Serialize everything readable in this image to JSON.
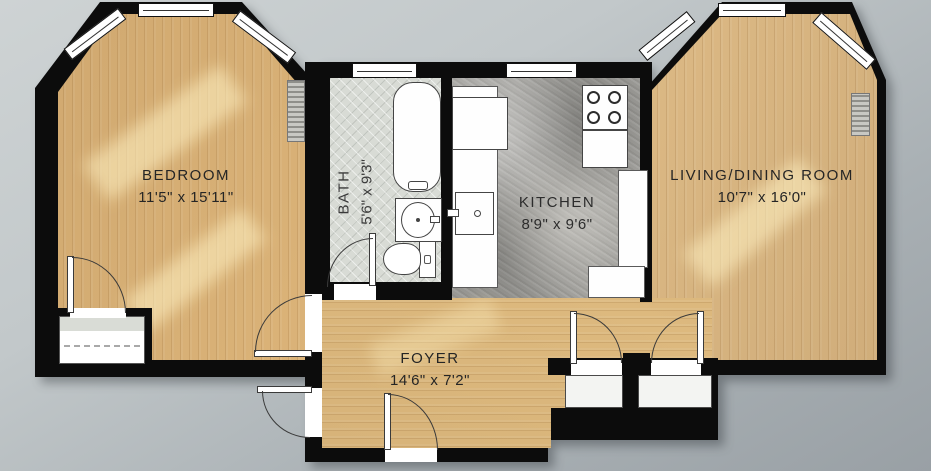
{
  "plan_title": "One-bedroom apartment floor plan",
  "rooms": {
    "bedroom": {
      "name": "BEDROOM",
      "dims": "11'5\" x 15'11\""
    },
    "bath": {
      "name": "BATH",
      "dims": "5'6\" x 9'3\""
    },
    "kitchen": {
      "name": "KITCHEN",
      "dims": "8'9\" x 9'6\""
    },
    "living": {
      "name": "LIVING/DINING ROOM",
      "dims": "10'7\" x 16'0\""
    },
    "foyer": {
      "name": "FOYER",
      "dims": "14'6\" x 7'2\""
    }
  },
  "colors": {
    "wall": "#0c0c0c",
    "wood_floor": "#dcb479",
    "bath_tile": "#d8dbd5",
    "kitchen_stone": "#a1a09c",
    "background": "#b7bdc0",
    "fixture": "#ffffff",
    "label_text": "#252525"
  }
}
